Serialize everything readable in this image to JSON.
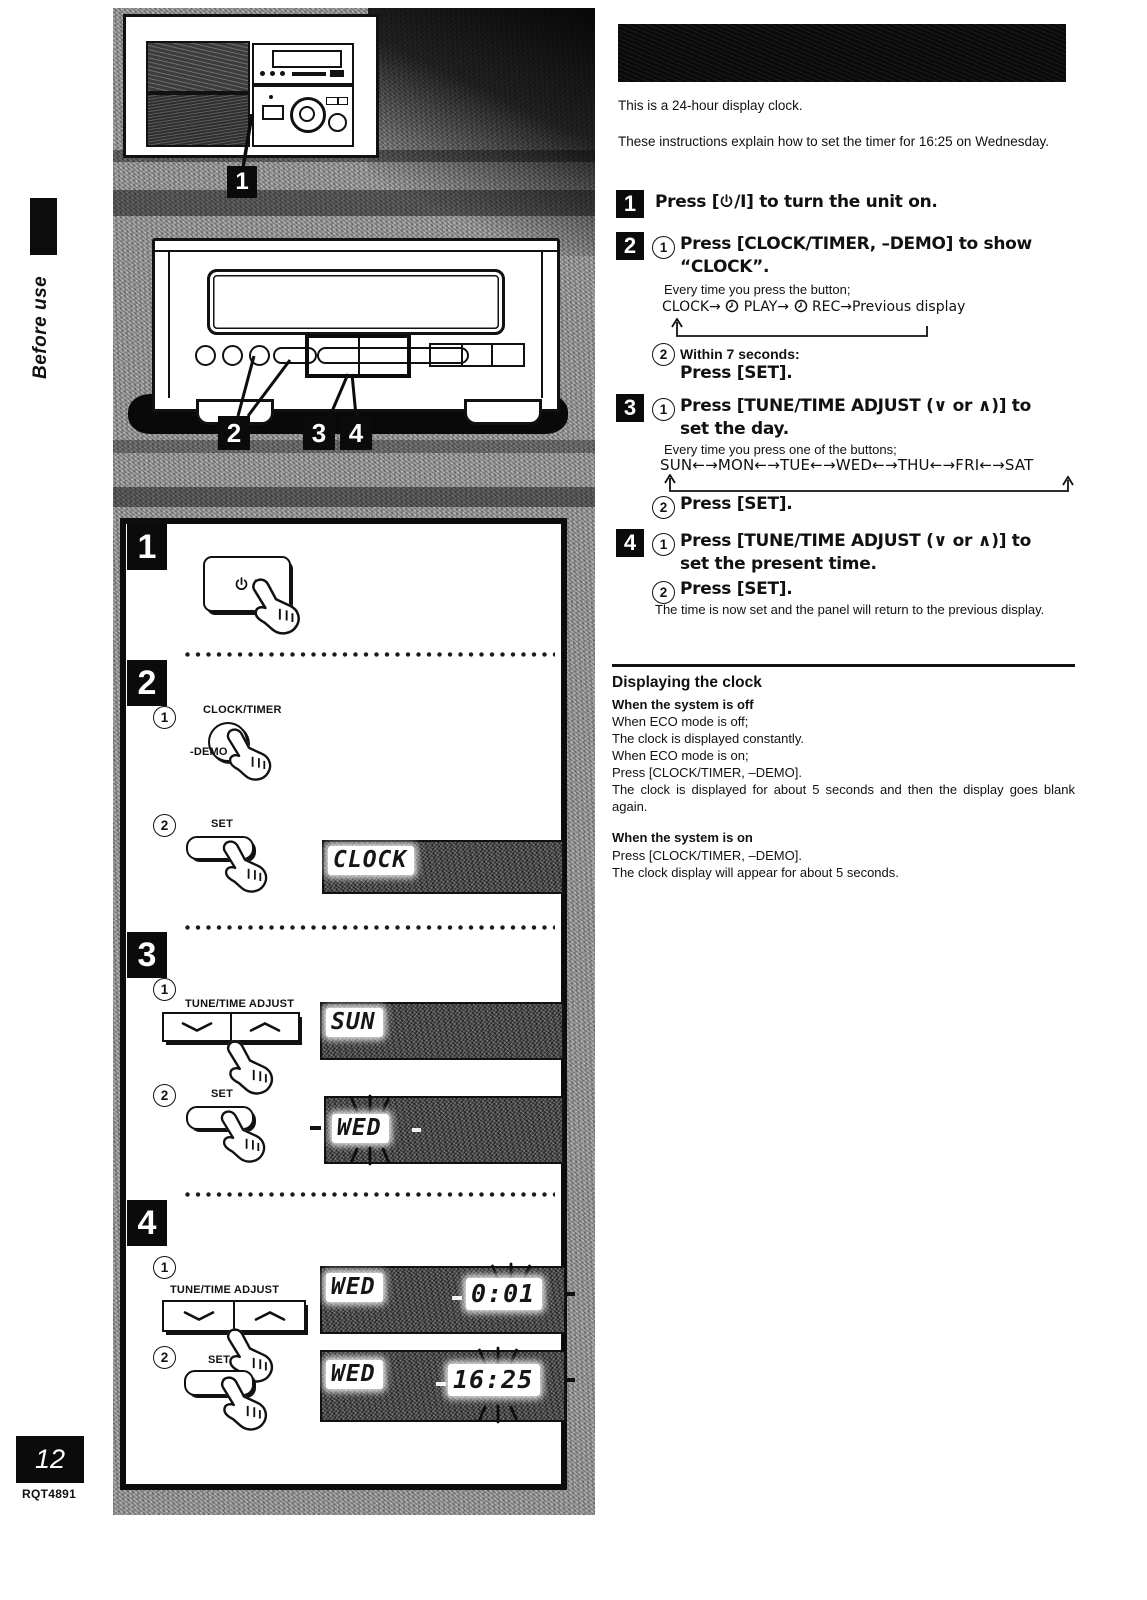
{
  "page": {
    "number": "12",
    "code": "RQT4891",
    "side_label": "Before use"
  },
  "intro": {
    "p1": "This is a 24-hour display clock.",
    "p2": "These instructions explain how to set the timer for 16:25 on Wednesday."
  },
  "right": {
    "s1_num": "1",
    "s1_pre": "Press [",
    "s1_post": "/I] to turn the unit on.",
    "s2_num": "2",
    "c_one": "1",
    "c_two": "2",
    "s2_h1a": "Press [CLOCK/TIMER, –DEMO] to show",
    "s2_h1b": "“CLOCK”.",
    "s2_note": "Every time you press the button;",
    "s2_cycle_a": "CLOCK→",
    "s2_cycle_b": "PLAY→",
    "s2_cycle_c": "REC→Previous display",
    "s2_h2": "Within 7 seconds:",
    "s2_h3": "Press [SET].",
    "s3_num": "3",
    "s3_h1a": "Press [TUNE/TIME ADJUST (∨ or ∧)] to",
    "s3_h1b": "set the day.",
    "s3_note": "Every time you press one of the buttons;",
    "s3_cycle": "SUN←→MON←→TUE←→WED←→THU←→FRI←→SAT",
    "s3_h2": "Press [SET].",
    "s4_num": "4",
    "s4_h1a": "Press [TUNE/TIME ADJUST (∨ or ∧)] to",
    "s4_h1b": "set the present time.",
    "s4_h2": "Press [SET].",
    "s4_note": "The time is now set and the panel will return to the previous display."
  },
  "clocksec": {
    "title": "Displaying the clock",
    "off_h": "When the system is off",
    "off1": "When ECO mode is off;",
    "off2": "The clock is displayed constantly.",
    "off3": "When ECO mode is on;",
    "off4": "Press [CLOCK/TIMER, –DEMO].",
    "off5": "The clock is displayed for about 5 seconds and then the display goes blank again.",
    "on_h": "When the system is on",
    "on1": "Press [CLOCK/TIMER, –DEMO].",
    "on2": "The clock display will appear for about 5 seconds."
  },
  "box": {
    "s1": "1",
    "s2": "2",
    "s3": "3",
    "s4": "4",
    "c_one": "1",
    "c_two": "2",
    "power_suffix": "/I",
    "clock_timer": "CLOCK/TIMER",
    "demo": "-DEMO",
    "set": "SET",
    "tune": "TUNE/TIME ADJUST"
  },
  "callouts": {
    "c1": "1",
    "c2": "2",
    "c3": "3",
    "c4": "4"
  },
  "displays": {
    "clock": "CLOCK",
    "sun": "SUN",
    "wed": "WED",
    "t1_day": "WED",
    "t1_time": "0:01",
    "t2_day": "WED",
    "t2_time": "16:25"
  }
}
